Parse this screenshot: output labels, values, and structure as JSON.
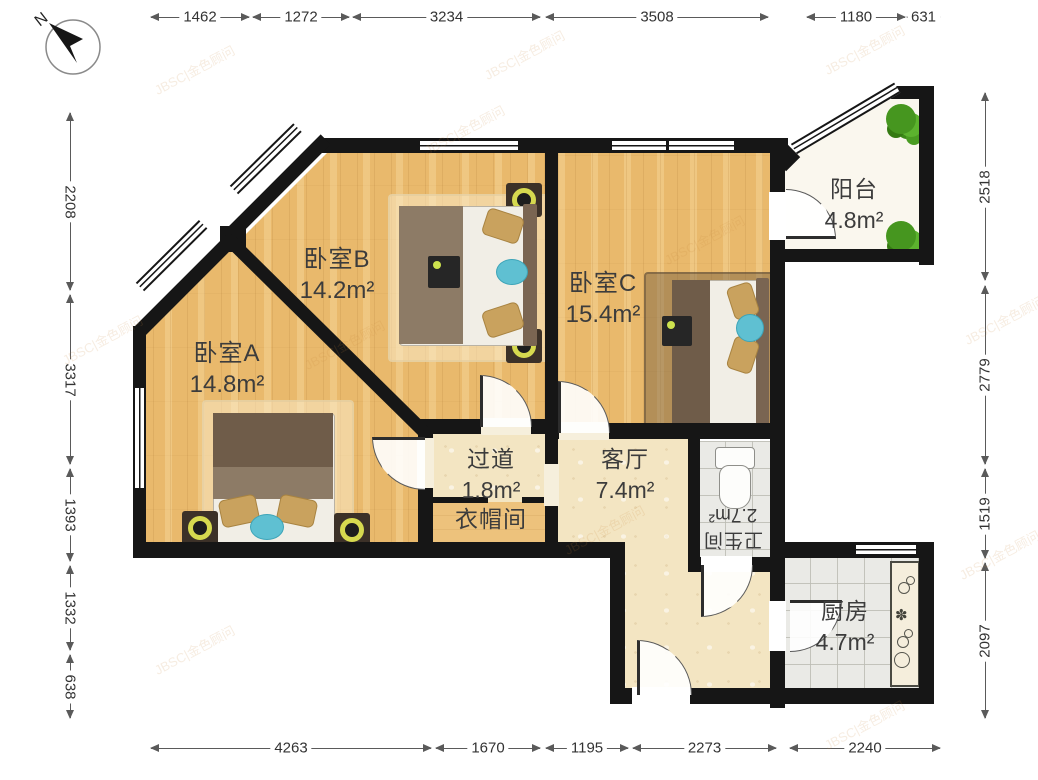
{
  "compass": {
    "label": "N"
  },
  "watermark": {
    "text": "JBSC|金色顾问"
  },
  "rooms": [
    {
      "name": "卧室A",
      "area": "14.8m²"
    },
    {
      "name": "卧室B",
      "area": "14.2m²"
    },
    {
      "name": "卧室C",
      "area": "15.4m²"
    },
    {
      "name": "阳台",
      "area": "4.8m²"
    },
    {
      "name": "过道",
      "area": "1.8m²"
    },
    {
      "name": "衣帽间",
      "area": ""
    },
    {
      "name": "客厅",
      "area": "7.4m²"
    },
    {
      "name": "卫生间",
      "area": "2.7m²"
    },
    {
      "name": "厨房",
      "area": "4.7m²"
    }
  ],
  "dimensions": {
    "top": [
      {
        "label": "1462",
        "from": 150,
        "to": 250
      },
      {
        "label": "1272",
        "from": 252,
        "to": 350
      },
      {
        "label": "3234",
        "from": 352,
        "to": 541
      },
      {
        "label": "3508",
        "from": 545,
        "to": 769
      },
      {
        "label": "1180",
        "from": 806,
        "to": 906
      },
      {
        "label": "631",
        "from": 906,
        "to": 941
      }
    ],
    "bottom": [
      {
        "label": "4263",
        "from": 150,
        "to": 432
      },
      {
        "label": "1670",
        "from": 435,
        "to": 541
      },
      {
        "label": "1195",
        "from": 545,
        "to": 629
      },
      {
        "label": "2273",
        "from": 632,
        "to": 777
      },
      {
        "label": "2240",
        "from": 789,
        "to": 941
      }
    ],
    "left": [
      {
        "label": "2208",
        "from": 112,
        "to": 291
      },
      {
        "label": "3317",
        "from": 294,
        "to": 465
      },
      {
        "label": "1393",
        "from": 468,
        "to": 562
      },
      {
        "label": "1332",
        "from": 565,
        "to": 651
      },
      {
        "label": "638",
        "from": 654,
        "to": 719
      }
    ],
    "right": [
      {
        "label": "2518",
        "from": 92,
        "to": 281
      },
      {
        "label": "2779",
        "from": 285,
        "to": 465
      },
      {
        "label": "1519",
        "from": 468,
        "to": 559
      },
      {
        "label": "2097",
        "from": 562,
        "to": 719
      }
    ]
  }
}
